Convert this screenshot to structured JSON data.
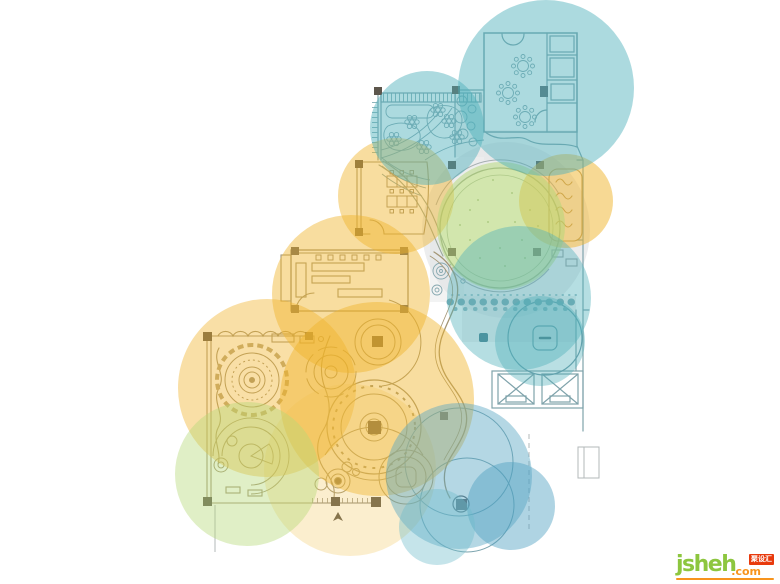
{
  "watermark": {
    "brand": "jsheh",
    "tld": ".com",
    "badge": "聚设汇"
  },
  "palette": {
    "highlight_yellow": "#f0b32a",
    "highlight_teal": "#4fb0ba",
    "highlight_green": "#b5d878",
    "highlight_blue": "#58a7c4",
    "logo_green": "#8dc63f",
    "logo_orange": "#f7941d",
    "badge_red": "#e83a0d",
    "plan_line_cool": "#7fa3ab",
    "plan_line_warm": "#a39574",
    "column_dark": "#5d564c"
  },
  "overlay_circles": [
    {
      "id": "yellow-1",
      "cx": 396,
      "cy": 196,
      "r": 58,
      "color": "#f0b32a",
      "opacity": 0.45
    },
    {
      "id": "yellow-2",
      "cx": 566,
      "cy": 201,
      "r": 47,
      "color": "#f0b32a",
      "opacity": 0.5
    },
    {
      "id": "yellow-3",
      "cx": 267,
      "cy": 388,
      "r": 89,
      "color": "#f0b32a",
      "opacity": 0.42
    },
    {
      "id": "yellow-4",
      "cx": 351,
      "cy": 294,
      "r": 79,
      "color": "#f0b32a",
      "opacity": 0.45
    },
    {
      "id": "yellow-5",
      "cx": 377,
      "cy": 399,
      "r": 97,
      "color": "#f0b32a",
      "opacity": 0.45
    },
    {
      "id": "yellow-6",
      "cx": 350,
      "cy": 470,
      "r": 86,
      "color": "#f2c24e",
      "opacity": 0.28
    },
    {
      "id": "green-1",
      "cx": 501,
      "cy": 226,
      "r": 64,
      "color": "#b5d878",
      "opacity": 0.52
    },
    {
      "id": "green-2",
      "cx": 247,
      "cy": 474,
      "r": 72,
      "color": "#b5d878",
      "opacity": 0.42
    },
    {
      "id": "teal-1",
      "cx": 546,
      "cy": 88,
      "r": 88,
      "color": "#4fb0ba",
      "opacity": 0.47
    },
    {
      "id": "teal-2",
      "cx": 427,
      "cy": 128,
      "r": 57,
      "color": "#4fb0ba",
      "opacity": 0.47
    },
    {
      "id": "teal-3",
      "cx": 519,
      "cy": 298,
      "r": 72,
      "color": "#4fb0ba",
      "opacity": 0.42
    },
    {
      "id": "teal-4",
      "cx": 540,
      "cy": 341,
      "r": 45,
      "color": "#4fb0ba",
      "opacity": 0.4
    },
    {
      "id": "blue-1",
      "cx": 459,
      "cy": 476,
      "r": 73,
      "color": "#58a7c4",
      "opacity": 0.45
    },
    {
      "id": "blue-2",
      "cx": 511,
      "cy": 506,
      "r": 44,
      "color": "#4d9fc0",
      "opacity": 0.45
    },
    {
      "id": "blue-3",
      "cx": 437,
      "cy": 527,
      "r": 38,
      "color": "#6fbcca",
      "opacity": 0.4
    }
  ]
}
